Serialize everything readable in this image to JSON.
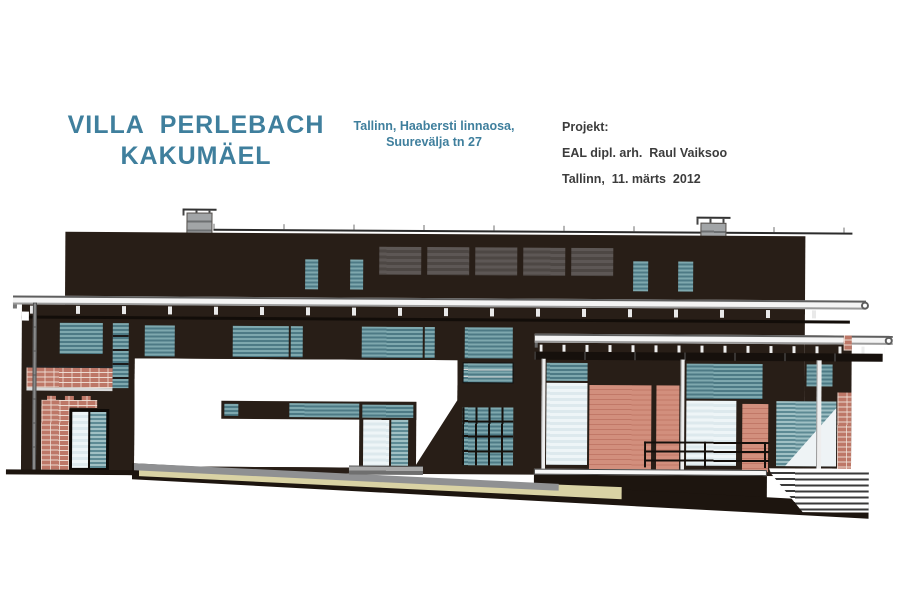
{
  "document": {
    "title_line1": "VILLA  PERLEBACH",
    "title_line2": "KAKUMÄEL",
    "location_line1": "Tallinn, Haabersti linnaosa,",
    "location_line2": "Suurevälja tn 27",
    "project_label": "Projekt:",
    "project_architect": "EAL dipl. arh.  Raul Vaiksoo",
    "project_date": "Tallinn,  11. märts  2012"
  },
  "drawing_subject": "street elevation of a dark single-family villa with flat roof, two chimneys, long eave canopies, teal ribbon windows, salmon wood panels, brick piers, carport opening, terrace railing and right-side stairs on sloping ground",
  "colors": {
    "title_teal": "#3f7f9d",
    "text_dark": "#3c3c3c",
    "building_dark": "#281e17",
    "ground_dark": "#1d150f",
    "window_teal": "#5d8a94",
    "glass_pale": "#dde9ed",
    "wood_salmon": "#d28f7d",
    "brick": "#bd7767",
    "terrain_tan": "#d9d2a4",
    "driveway_gray": "#8f9092",
    "canopy_white": "#f4f4f4",
    "chimney_gray": "#a2a5a7",
    "clerestory_gray": "#4d4744"
  }
}
